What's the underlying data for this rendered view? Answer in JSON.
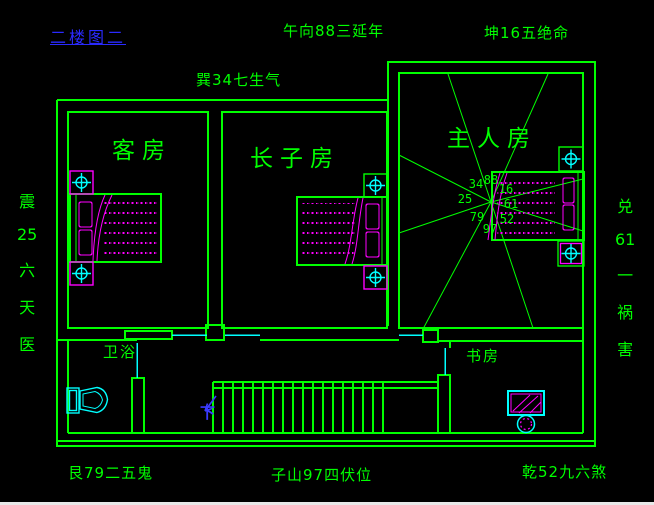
{
  "colors": {
    "line_green": "#00ff00",
    "furniture_magenta": "#ff00ff",
    "fixture_cyan": "#00ffff",
    "title_blue": "#2a2aff",
    "background": "#000000"
  },
  "title": {
    "text": "二楼图二"
  },
  "annotations": {
    "top_center": "午向88三延年",
    "top_right": "坤16五绝命",
    "upper_left": "巽34七生气",
    "left": {
      "segments": [
        "震",
        "25",
        "六",
        "天",
        "医"
      ]
    },
    "right": {
      "segments": [
        "兑",
        "61",
        "一",
        "祸",
        "害"
      ]
    },
    "bottom_left": "艮79二五鬼",
    "bottom_center": "子山97四伏位",
    "bottom_right": "乾52九六煞"
  },
  "rooms": {
    "guest": "客房",
    "eldest_son": "长子房",
    "master": "主人房",
    "bathroom": "卫浴",
    "study": "书房"
  },
  "compass_numbers": {
    "nw": "34",
    "n": "88",
    "ne": "16",
    "w": "25",
    "e": "61",
    "sw": "79",
    "s": "97",
    "se": "52"
  },
  "stairs": {
    "down_label": "下"
  }
}
